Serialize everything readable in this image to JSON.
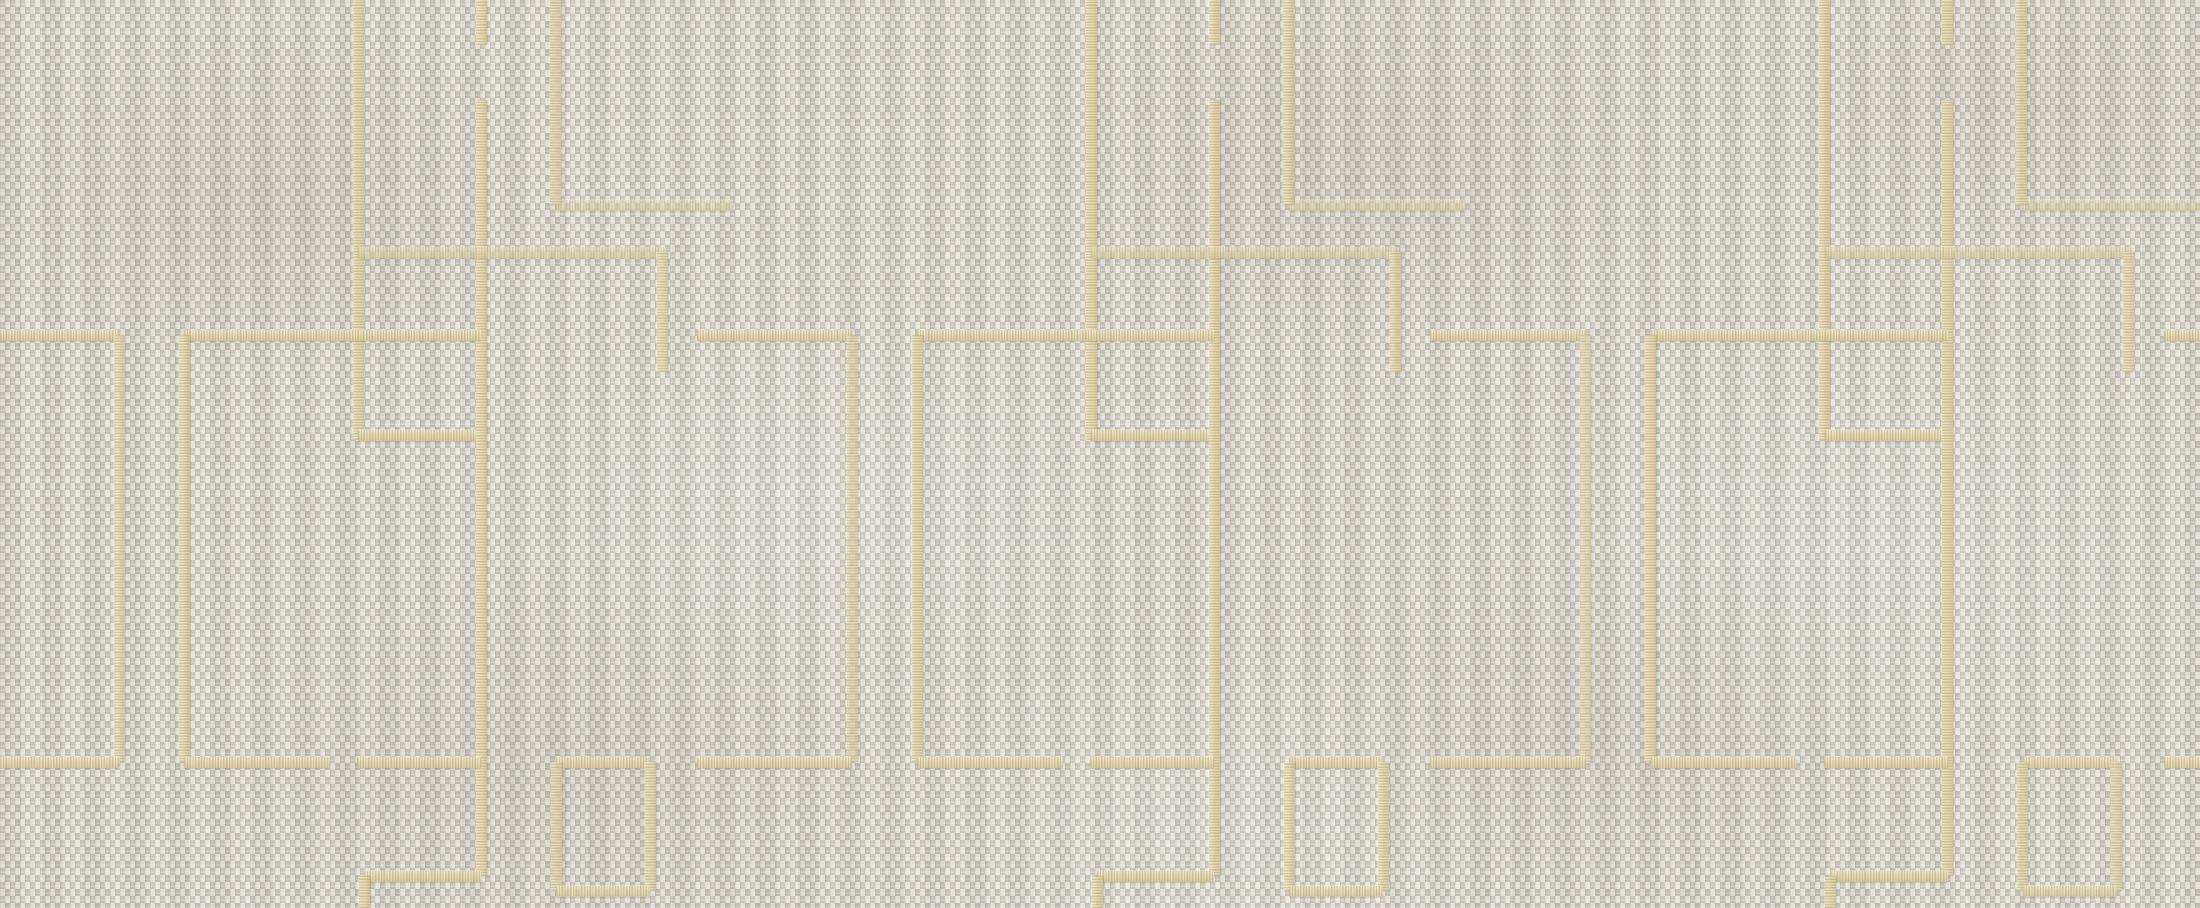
{
  "scene": {
    "type": "textile-wallpaper-texture",
    "description": "Grey woven linen basketweave fabric with embroidered cream-gold geometric fret lines forming interlocking rectangular outlines; pattern repeats horizontally three times",
    "width_px": 2200,
    "height_px": 908,
    "text_content": "none"
  },
  "palette": {
    "weave_mid": "#d5d1c8",
    "weave_light": "#e9e6e0",
    "weave_light2": "#e4e1da",
    "weave_dark": "#c3beb3",
    "weave_dark2": "#cac5ba",
    "thread_light": "#f1e9cf",
    "thread_base": "#e7ddb8",
    "thread_deep": "#d9cb9d"
  },
  "pattern": {
    "tile_width": 733.33,
    "tile_offsets": [
      0,
      733.33,
      1466.67
    ],
    "line_thickness": 11,
    "segments": [
      {
        "orient": "v",
        "x": 358,
        "y": 0,
        "len": 440,
        "tone": "strong"
      },
      {
        "orient": "h",
        "x": 358,
        "y": 435,
        "len": 123,
        "tone": "strong"
      },
      {
        "orient": "v",
        "x": 481,
        "y": 0,
        "len": 45,
        "tone": "strong"
      },
      {
        "orient": "v",
        "x": 481,
        "y": 100,
        "len": 776,
        "tone": "strong"
      },
      {
        "orient": "h",
        "x": 0,
        "y": 335,
        "len": 119,
        "tone": "strong"
      },
      {
        "orient": "v",
        "x": 119,
        "y": 335,
        "len": 427,
        "tone": "faint"
      },
      {
        "orient": "h",
        "x": 184,
        "y": 335,
        "len": 297,
        "tone": "strong"
      },
      {
        "orient": "v",
        "x": 184,
        "y": 335,
        "len": 427,
        "tone": "strong"
      },
      {
        "orient": "h",
        "x": 697,
        "y": 335,
        "len": 37,
        "tone": "strong"
      },
      {
        "orient": "h",
        "x": 0,
        "y": 762,
        "len": 119,
        "tone": "strong"
      },
      {
        "orient": "h",
        "x": 184,
        "y": 762,
        "len": 146,
        "tone": "strong"
      },
      {
        "orient": "h",
        "x": 357,
        "y": 762,
        "len": 124,
        "tone": "strong"
      },
      {
        "orient": "h",
        "x": 556,
        "y": 762,
        "len": 94,
        "tone": "strong"
      },
      {
        "orient": "h",
        "x": 697,
        "y": 762,
        "len": 37,
        "tone": "strong"
      },
      {
        "orient": "v",
        "x": 556,
        "y": 762,
        "len": 129,
        "tone": "medium"
      },
      {
        "orient": "v",
        "x": 650,
        "y": 762,
        "len": 129,
        "tone": "medium"
      },
      {
        "orient": "h",
        "x": 556,
        "y": 891,
        "len": 94,
        "tone": "medium"
      },
      {
        "orient": "h",
        "x": 364,
        "y": 876,
        "len": 117,
        "tone": "strong"
      },
      {
        "orient": "v",
        "x": 364,
        "y": 876,
        "len": 32,
        "tone": "strong"
      },
      {
        "orient": "h",
        "x": 555,
        "y": 205,
        "len": 178,
        "tone": "xfaint"
      },
      {
        "orient": "v",
        "x": 555,
        "y": 0,
        "len": 205,
        "tone": "medium"
      },
      {
        "orient": "h",
        "x": 358,
        "y": 252,
        "len": 308,
        "tone": "faint"
      },
      {
        "orient": "v",
        "x": 662,
        "y": 252,
        "len": 120,
        "tone": "medium"
      }
    ]
  }
}
